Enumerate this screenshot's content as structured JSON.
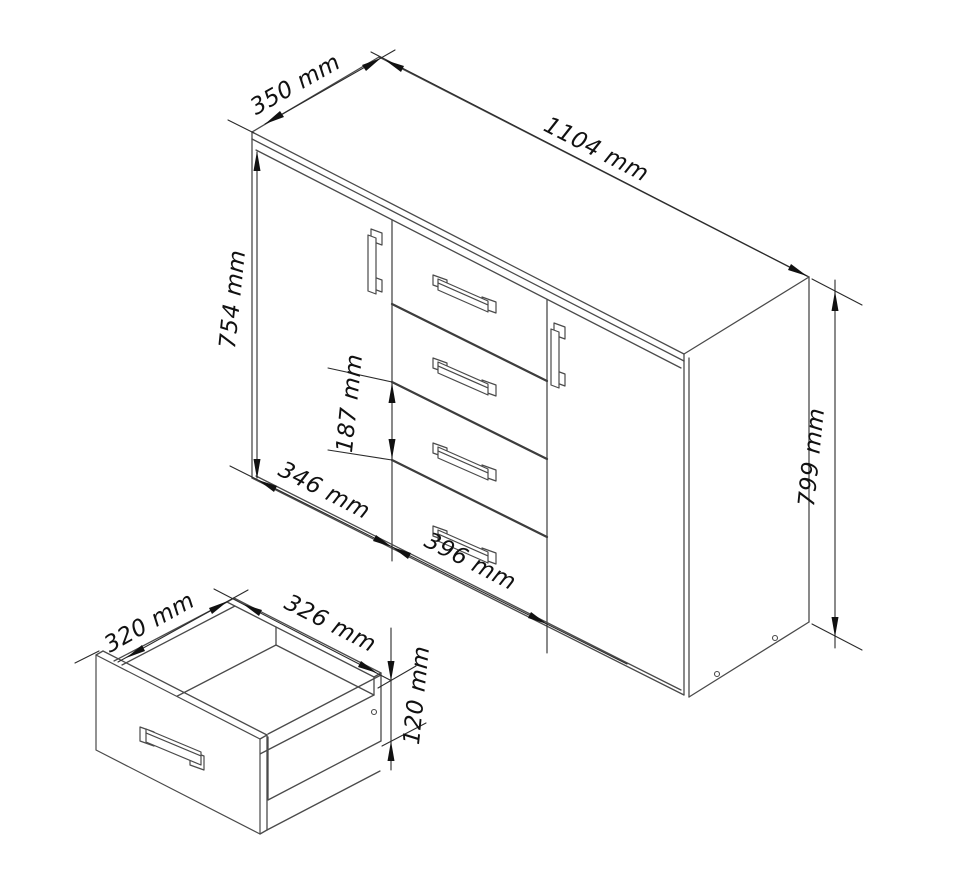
{
  "diagram": {
    "unit": "mm",
    "cabinet": {
      "dims": {
        "depth": "350 mm",
        "width": "1104 mm",
        "front_height": "754 mm",
        "drawer_pitch": "187 mm",
        "left_door_width": "346 mm",
        "drawer_section_width": "396 mm",
        "side_height": "799 mm"
      }
    },
    "drawer_box": {
      "dims": {
        "depth": "320 mm",
        "width": "326 mm",
        "height": "120 mm"
      }
    }
  }
}
